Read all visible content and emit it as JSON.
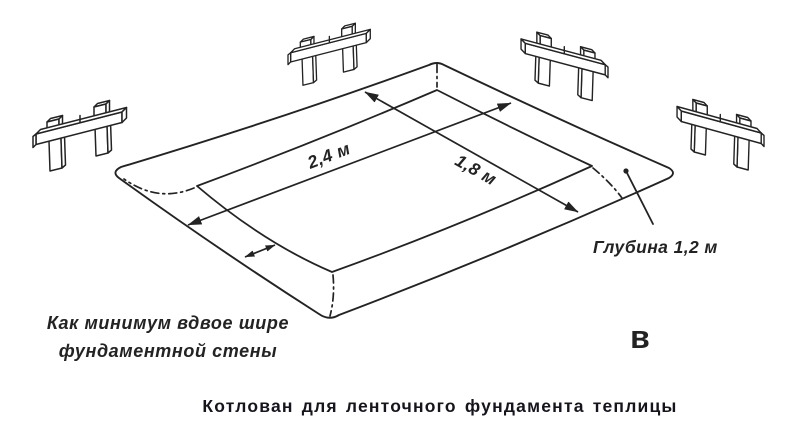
{
  "background": "#ffffff",
  "colors": {
    "ink": "#232323",
    "caption_text": "#15151d"
  },
  "labels": {
    "dim_long": "2,4 м",
    "dim_short": "1,8 м",
    "depth": "Глубина 1,2 м",
    "width_note_line1": "Как минимум вдвое шире",
    "width_note_line2": "фундаментной стены",
    "part_letter": "в"
  },
  "caption": "Котлован для ленточного фундамента теплицы",
  "icons": {
    "batter_board": "batter-board-icon"
  }
}
